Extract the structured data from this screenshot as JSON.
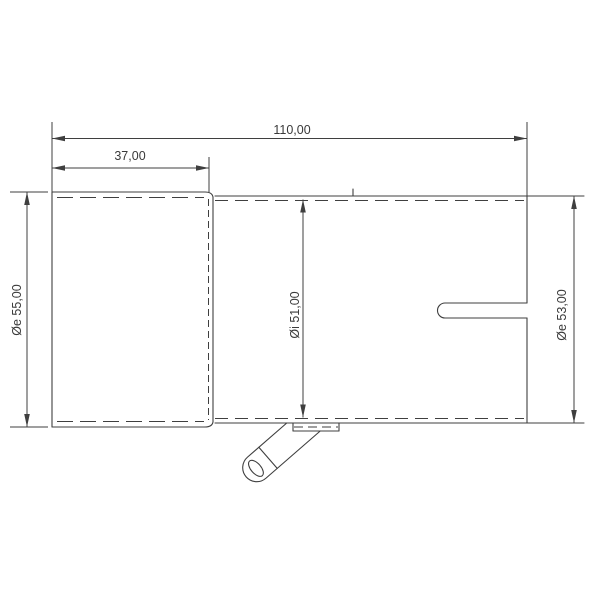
{
  "drawing": {
    "background_color": "#ffffff",
    "line_color": "#3f3f3f",
    "text_color": "#3a3a3a",
    "dimensions": {
      "overall_length": "110,00",
      "socket_length": "37,00",
      "left_outer_diameter": "Øe 55,00",
      "inner_diameter": "Øi 51,00",
      "right_outer_diameter": "Øe 53,00"
    }
  }
}
